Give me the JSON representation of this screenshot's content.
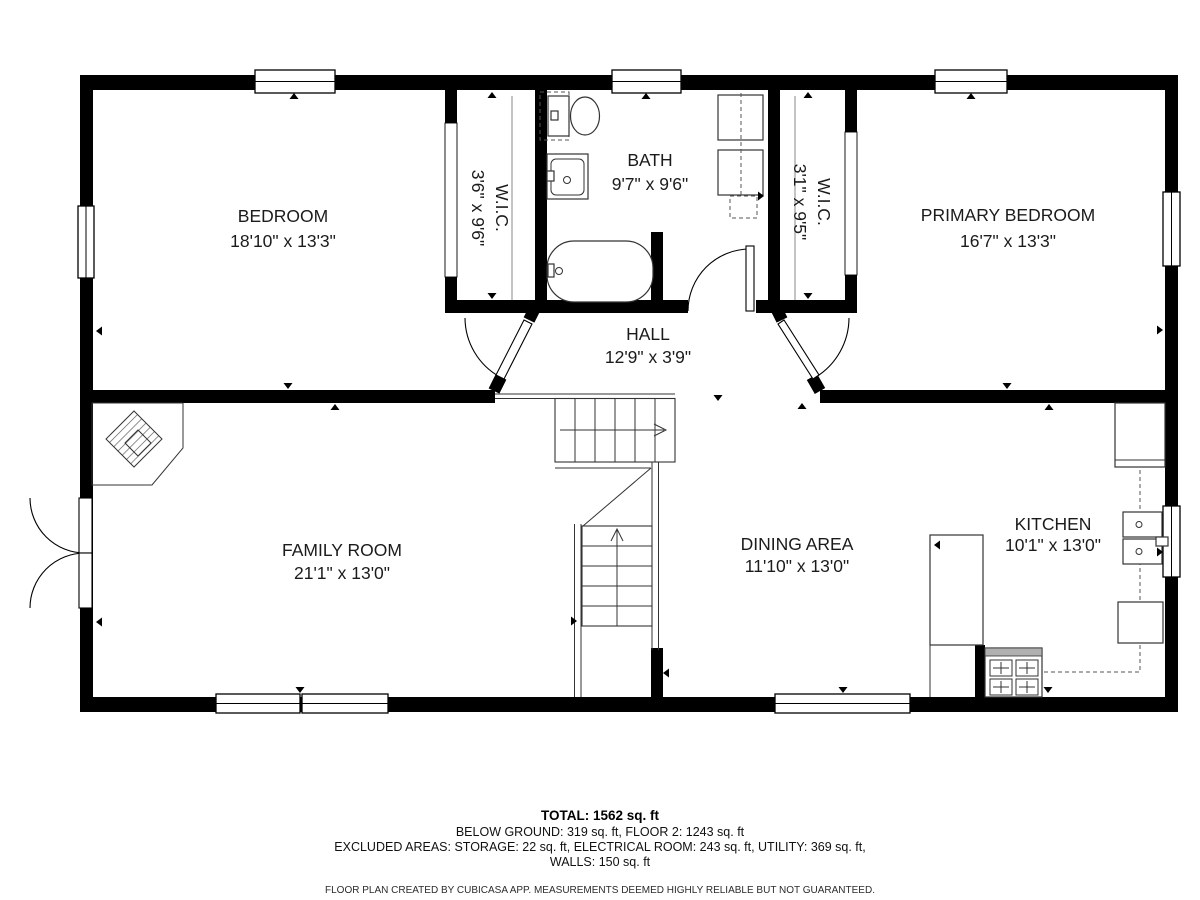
{
  "plan": {
    "rooms": [
      {
        "name": "BEDROOM",
        "dims": "18'10\" x 13'3\""
      },
      {
        "name": "W.I.C.",
        "dims": "3'6\" x 9'6\""
      },
      {
        "name": "BATH",
        "dims": "9'7\" x 9'6\""
      },
      {
        "name": "W.I.C.",
        "dims": "3'1\" x 9'5\""
      },
      {
        "name": "PRIMARY BEDROOM",
        "dims": "16'7\" x 13'3\""
      },
      {
        "name": "HALL",
        "dims": "12'9\" x 3'9\""
      },
      {
        "name": "FAMILY ROOM",
        "dims": "21'1\" x 13'0\""
      },
      {
        "name": "DINING AREA",
        "dims": "11'10\" x 13'0\""
      },
      {
        "name": "KITCHEN",
        "dims": "10'1\" x 13'0\""
      }
    ]
  },
  "summary": {
    "total": "TOTAL: 1562 sq. ft",
    "below_ground": "BELOW GROUND: 319 sq. ft, FLOOR 2: 1243 sq. ft",
    "excluded": "EXCLUDED AREAS: STORAGE: 22 sq. ft, ELECTRICAL ROOM: 243 sq. ft, UTILITY: 369 sq. ft,",
    "walls": "WALLS: 150 sq. ft",
    "disclaimer": "FLOOR PLAN CREATED BY CUBICASA APP. MEASUREMENTS DEEMED HIGHLY RELIABLE BUT NOT GUARANTEED."
  },
  "colors": {
    "wall": "#000000",
    "background": "#ffffff",
    "fixture": "#333333"
  }
}
